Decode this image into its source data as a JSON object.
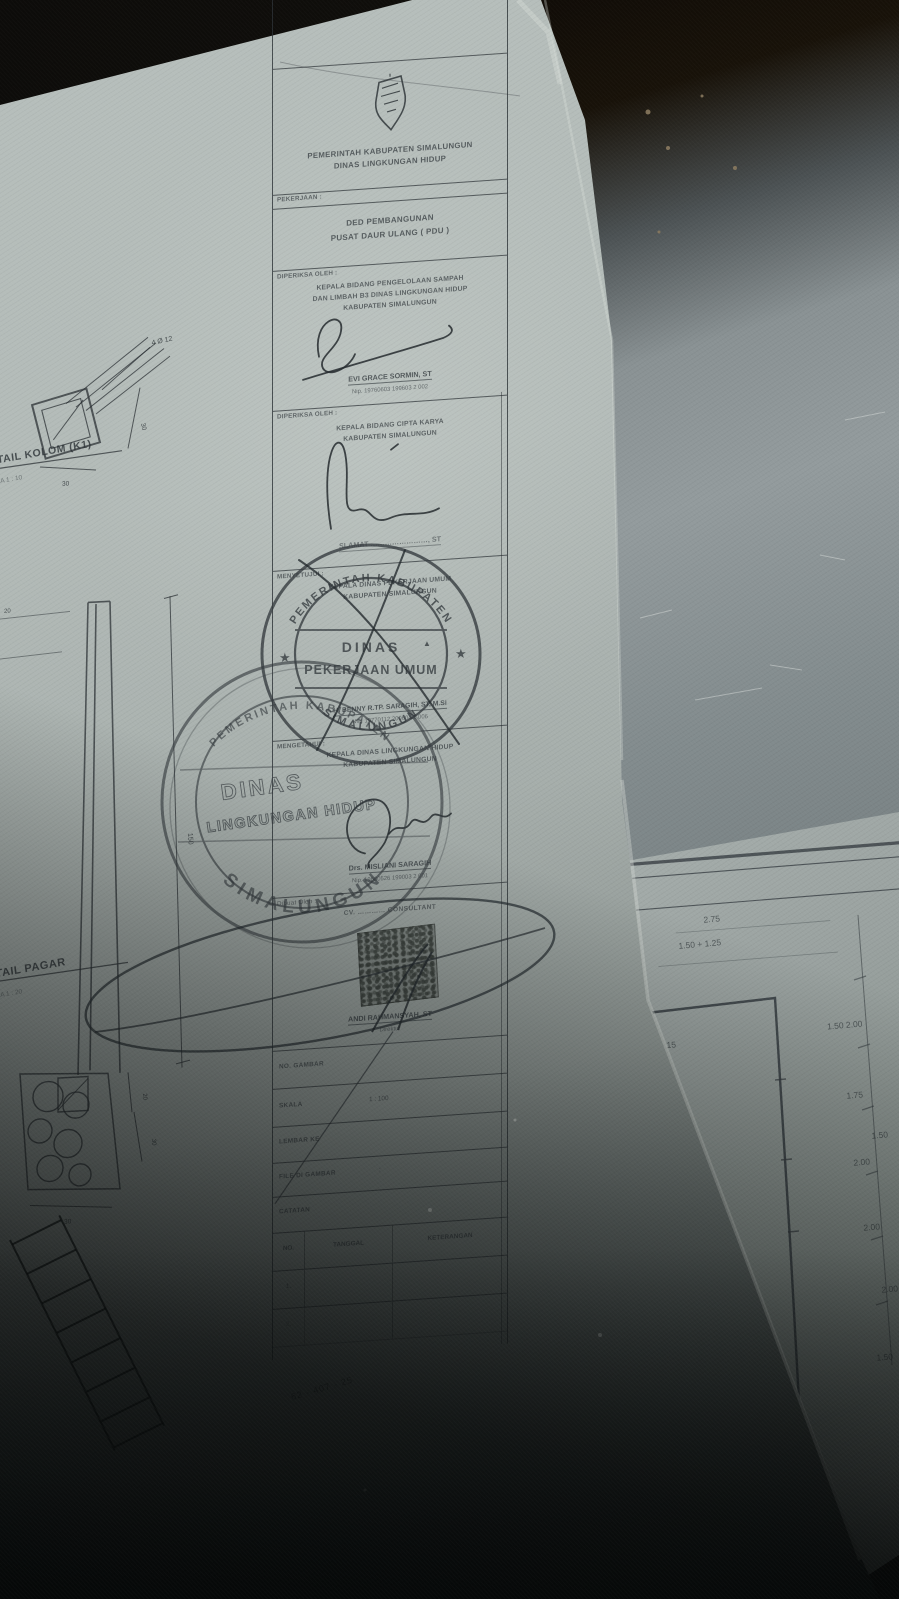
{
  "colors": {
    "ink": "#2a3034",
    "paper": "#b4bcb9",
    "floor": "#8a9294",
    "shadow": "#0a0c0c"
  },
  "titleblock": {
    "header": {
      "line1": "PEMERINTAH KABUPATEN SIMALUNGUN",
      "line2": "DINAS LINGKUNGAN HIDUP"
    },
    "pekerjaan": {
      "label": "PEKERJAAN :",
      "line1": "DED PEMBANGUNAN",
      "line2": "PUSAT DAUR ULANG ( PDU )"
    },
    "diperiksa1": {
      "label": "DIPERIKSA OLEH :",
      "title_lines": [
        "KEPALA BIDANG PENGELOLAAN SAMPAH",
        "DAN LIMBAH B3 DINAS LINGKUNGAN HIDUP",
        "KABUPATEN SIMALUNGUN"
      ],
      "name": "EVI GRACE SORMIN, ST",
      "nip": "Nip. 19760603 199603 2 002"
    },
    "diperiksa2": {
      "label": "DIPERIKSA OLEH :",
      "title_lines": [
        "KEPALA BIDANG CIPTA KARYA",
        "KABUPATEN SIMALUNGUN"
      ],
      "name": "SLAMAT ……………………, ST"
    },
    "menyetujui": {
      "label": "MENYETUJUI :",
      "title_lines": [
        "KEPALA DINAS PEKERJAAN UMUM",
        "KABUPATEN SIMALUNGUN"
      ],
      "name": "H. BENNY R.TP. SARAGIH, ST, M.Si",
      "nip": "NIP. 19770112 200604 1 006"
    },
    "mengetahui": {
      "label": "MENGETAHUI :",
      "title_lines": [
        "KEPALA DINAS LINGKUNGAN HIDUP",
        "KABUPATEN SIMALUNGUN"
      ],
      "name": "Drs. MISLIANI SARAGIH",
      "nip": "Nip. 19630526 199003 2 001"
    },
    "dibuat": {
      "label": "Dibuat Oleh :",
      "company": "CV. ………… CONSULTANT",
      "name": "ANDI RAHMANSYAH, ST",
      "role": "Direktur"
    },
    "table": {
      "no_gambar": "NO. GAMBAR",
      "skala_label": "SKALA",
      "skala_value": "1 : 100",
      "lembar": "LEMBAR KE",
      "file": "FILE DI GAMBAR",
      "file_colon": ":",
      "catatan": "CATATAN",
      "cols": [
        "NO.",
        "TANGGAL",
        "KETERANGAN"
      ],
      "rows": [
        "1.",
        "2."
      ]
    }
  },
  "stamps": {
    "pu": {
      "ring_top": "PEMERINTAH KABUPATEN",
      "ring_bottom": "SIMALUNGUN",
      "center1": "DINAS",
      "center2": "PEKERJAAN UMUM",
      "star_left": "★",
      "star_right": "★",
      "mark": "▲"
    },
    "lh": {
      "ring_top": "PEMERINTAH KABUPATEN",
      "ring_bottom": "SIMALUNGUN",
      "center1": "DINAS",
      "center2": "LINGKUNGAN HIDUP"
    }
  },
  "left_drawings": {
    "kolom": {
      "title": "DETAIL KOLOM (K1)",
      "scale": "SKALA 1 : 10",
      "rebar": "4 Ø 12",
      "dim_side": "30",
      "dim_bottom": "30"
    },
    "section": {
      "dim_left": "20",
      "dim_height": "150",
      "dim_20": "20",
      "dim_30": "30",
      "dim_base": "30"
    },
    "pagar": {
      "title": "DETAIL PAGAR",
      "scale": "SKALA 1 : 20"
    }
  },
  "right_sheet": {
    "dims": [
      "2.75",
      "1.50 + 1.25",
      "3.15",
      "1.50 2.00",
      "1.75",
      "1.50",
      "2.00",
      "2.00",
      "2.00",
      "1.50"
    ]
  },
  "annotations": {
    "handwriting": "62 - 407 - 25"
  }
}
